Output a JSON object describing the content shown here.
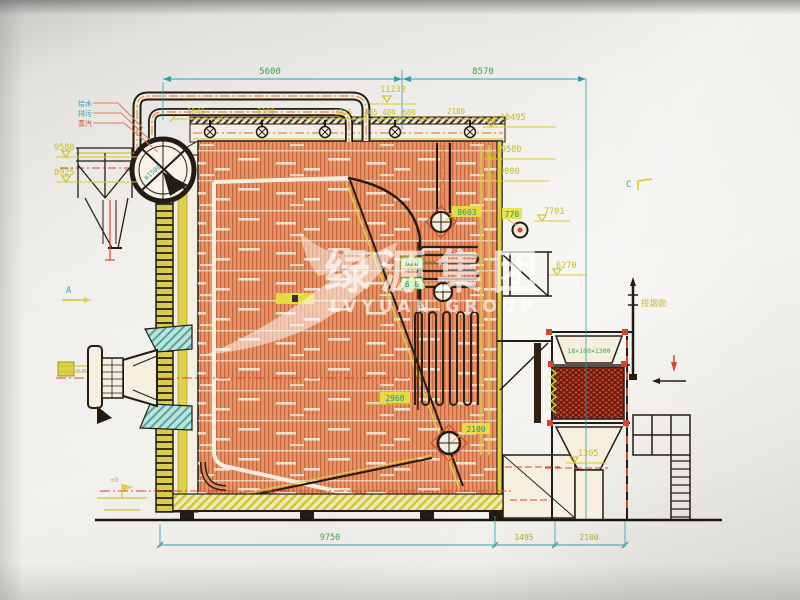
{
  "watermark": {
    "cn": "绿源集团",
    "en": "LVYUAN GROUP"
  },
  "markers": {
    "a": "A",
    "c": "C"
  },
  "drum": {
    "spec": "φ1500"
  },
  "pipes": {
    "feedwater": "给水",
    "blowdown": "排污",
    "steam": "蒸汽"
  },
  "eco": {
    "spec": "18×100×1300"
  },
  "flue": {
    "chimney": "接烟囱"
  },
  "datum": {
    "ground": "±0"
  },
  "dims_top": {
    "span_left": "5600",
    "span_right": "8570",
    "level": "11230",
    "seg1": "1540",
    "seg2": "3100",
    "seg3": "1255",
    "seg4": "465",
    "seg5": "480",
    "seg6": "680",
    "seg7": "2180"
  },
  "levels_left": {
    "upper": "9580",
    "lower": "8925"
  },
  "levels_right": {
    "r1": "10495",
    "r2": "9580",
    "r3": "9080",
    "r4": "7701",
    "r5": "6270",
    "r6": "1305"
  },
  "labels_inner": {
    "a": "8603",
    "b": "770",
    "c": "620",
    "d": "610",
    "e": "2960",
    "f": "2100"
  },
  "dims_bottom": {
    "seg1": "9750",
    "seg2": "1495",
    "seg3": "2100"
  },
  "colors": {
    "paper": "#efede8",
    "ink": "#241c14",
    "salmon": "#e69468",
    "accent_red": "#d4472e",
    "accent_yellow": "#c9bd25",
    "accent_green": "#3f9e4f",
    "accent_cyan": "#2e9fae",
    "teal": "#4fa8a0",
    "eco_red": "#8b2015"
  }
}
